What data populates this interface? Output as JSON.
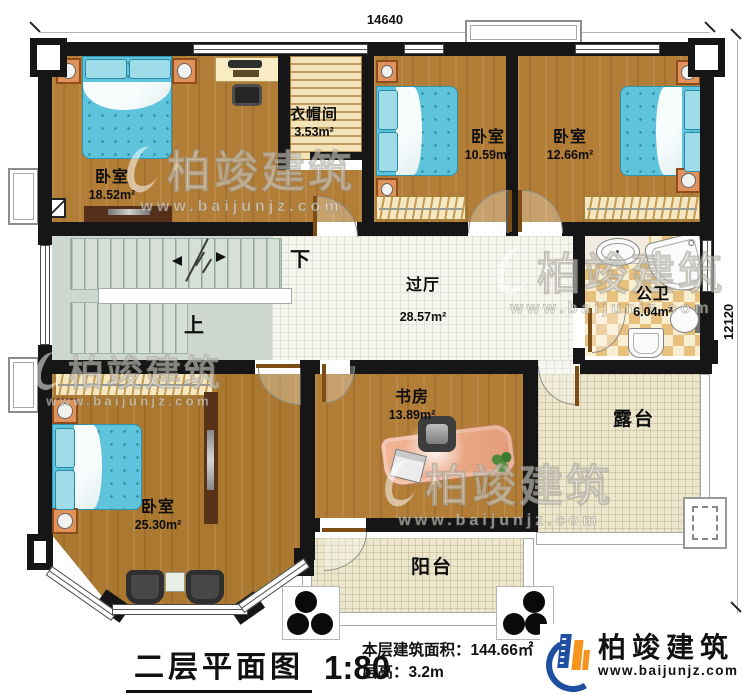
{
  "dimensions": {
    "top": "14640",
    "right": "12120"
  },
  "rooms": {
    "bedroom_tl": {
      "name": "卧室",
      "area": "18.52m²"
    },
    "cloakroom": {
      "name": "衣帽间",
      "area": "3.53m²"
    },
    "bedroom_tm": {
      "name": "卧室",
      "area": "10.59m²"
    },
    "bedroom_tr": {
      "name": "卧室",
      "area": "12.66m²"
    },
    "hall": {
      "name": "过厅",
      "area": "28.57m²"
    },
    "bathroom": {
      "name": "公卫",
      "area": "6.04m²"
    },
    "bedroom_bl": {
      "name": "卧室",
      "area": "25.30m²"
    },
    "study": {
      "name": "书房",
      "area": "13.89m²"
    },
    "terrace": {
      "name": "露台"
    },
    "balcony": {
      "name": "阳台"
    }
  },
  "stairs": {
    "down_label": "下",
    "up_label": "上"
  },
  "footer": {
    "title": "二层平面图",
    "scale": "1:80",
    "floor_area_label": "本层建筑面积：144.66㎡",
    "floor_height_label": "层高：3.2m"
  },
  "brand": {
    "name": "柏竣建筑",
    "website": "www.baijunjz.com"
  },
  "watermark": {
    "name": "柏竣建筑",
    "website": "www.baijunjz.com"
  },
  "colors": {
    "wall": "#161616",
    "wood": "#b17d37",
    "bed": "#5ec4db",
    "accent_orange": "#f7941d",
    "accent_blue": "#1e4fa1"
  }
}
